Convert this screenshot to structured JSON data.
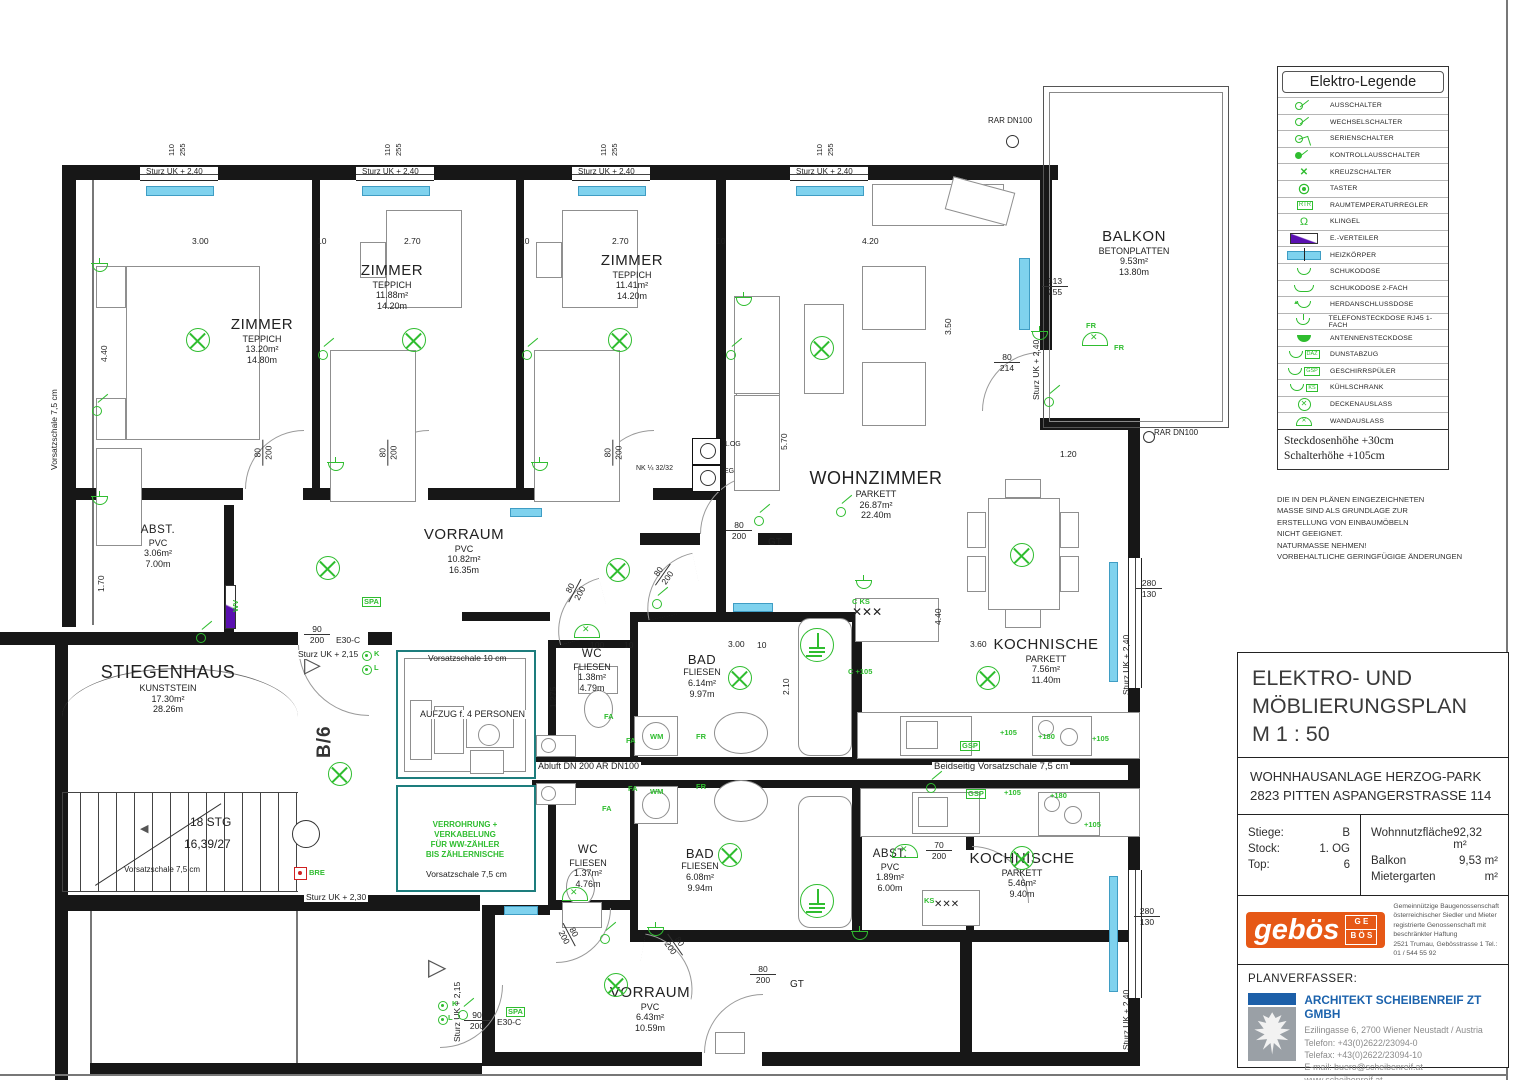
{
  "legend": {
    "title": "Elektro-Legende",
    "items": [
      {
        "icon": "ausschalter",
        "label": "AUSSCHALTER"
      },
      {
        "icon": "wechselschalter",
        "label": "WECHSELSCHALTER"
      },
      {
        "icon": "serienschalter",
        "label": "SERIENSCHALTER"
      },
      {
        "icon": "kontrollausschalter",
        "label": "KONTROLLAUSSCHALTER"
      },
      {
        "icon": "kreuzschalter",
        "label": "KREUZSCHALTER"
      },
      {
        "icon": "taster",
        "label": "TASTER"
      },
      {
        "icon": "rtr",
        "tag": "RTR",
        "label": "RAUMTEMPERATURREGLER"
      },
      {
        "icon": "klingel",
        "label": "KLINGEL"
      },
      {
        "icon": "everteiler",
        "label": "E.-VERTEILER"
      },
      {
        "icon": "heizkoerper",
        "label": "HEIZKÖRPER"
      },
      {
        "icon": "schuko",
        "label": "SCHUKODOSE"
      },
      {
        "icon": "schuko2",
        "label": "SCHUKODOSE 2-FACH"
      },
      {
        "icon": "herd",
        "label": "HERDANSCHLUSSDOSE"
      },
      {
        "icon": "telefon",
        "label": "TELEFONSTECKDOSE RJ45 1-FACH"
      },
      {
        "icon": "antenne",
        "label": "ANTENNENSTECKDOSE"
      },
      {
        "icon": "daz",
        "tag": "DAZ",
        "label": "DUNSTABZUG"
      },
      {
        "icon": "gsp",
        "tag": "GSP",
        "label": "GESCHIRRSPÜLER"
      },
      {
        "icon": "ks",
        "tag": "KS",
        "label": "KÜHLSCHRANK"
      },
      {
        "icon": "decke",
        "label": "DECKENAUSLASS"
      },
      {
        "icon": "wand",
        "label": "WANDAUSLASS"
      }
    ],
    "notes": [
      "Steckdosenhöhe  +30cm",
      "Schalterhöhe  +105cm"
    ],
    "disclaimer": [
      "DIE IN DEN PLÄNEN EINGEZEICHNETEN",
      "MASSE SIND ALS GRUNDLAGE ZUR",
      "ERSTELLUNG VON EINBAUMÖBELN",
      "NICHT GEEIGNET.",
      "NATURMASSE NEHMEN!",
      "VORBEHALTLICHE GERINGFÜGIGE ÄNDERUNGEN"
    ]
  },
  "title_block": {
    "title_lines": [
      "ELEKTRO- UND",
      "MÖBLIERUNGSPLAN",
      "M   1 : 50"
    ],
    "project_lines": [
      "WOHNHAUSANLAGE HERZOG-PARK",
      "2823 PITTEN ASPANGERSTRASSE 114"
    ],
    "info": {
      "stiege_label": "Stiege:",
      "stiege": "B",
      "stock_label": "Stock:",
      "stock": "1. OG",
      "top_label": "Top:",
      "top": "6",
      "wnf_label": "Wohnnutzfläche",
      "wnf": "92,32 m²",
      "balkon_label": "Balkon",
      "balkon": "9,53 m²",
      "garten_label": "Mietergarten",
      "garten": "m²"
    },
    "gebos": {
      "name": "gebös",
      "lines": [
        "Gemeinnützige Baugenossenschaft",
        "österreichischer Siedler und Mieter",
        "registrierte Genossenschaft mit beschränkter Haftung",
        "2521 Trumau, Gebösstrasse 1   Tel.: 01 / 544 55 92"
      ]
    },
    "planverfasser_label": "PLANVERFASSER:",
    "architect": {
      "name": "ARCHITEKT SCHEIBENREIF ZT GMBH",
      "address": "Ezilingasse 6, 2700 Wiener Neustadt / Austria",
      "phone": "Telefon: +43(0)2622/23094-0",
      "fax": "Telefax: +43(0)2622/23094-10",
      "email": "E-mail: buero@scheibenreif.at",
      "web": "www.scheibenreif.at"
    }
  },
  "rooms": {
    "zimmer1": {
      "name": "ZIMMER",
      "floor": "TEPPICH",
      "area": "13.20m²",
      "perimeter": "14.80m"
    },
    "zimmer2": {
      "name": "ZIMMER",
      "floor": "TEPPICH",
      "area": "11.88m²",
      "perimeter": "14.20m"
    },
    "zimmer3": {
      "name": "ZIMMER",
      "floor": "TEPPICH",
      "area": "11.41m²",
      "perimeter": "14.20m"
    },
    "wohnzimmer": {
      "name": "WOHNZIMMER",
      "floor": "PARKETT",
      "area": "26.87m²",
      "perimeter": "22.40m"
    },
    "balkon": {
      "name": "BALKON",
      "floor": "BETONPLATTEN",
      "area": "9.53m²",
      "perimeter": "13.80m"
    },
    "kochnische1": {
      "name": "KOCHNISCHE",
      "floor": "PARKETT",
      "area": "7.56m²",
      "perimeter": "11.40m"
    },
    "kochnische2": {
      "name": "KOCHNISCHE",
      "floor": "PARKETT",
      "area": "5.46m²",
      "perimeter": "9.40m"
    },
    "abst1": {
      "name": "ABST.",
      "floor": "PVC",
      "area": "3.06m²",
      "perimeter": "7.00m"
    },
    "abst2": {
      "name": "ABST.",
      "floor": "PVC",
      "area": "1.89m²",
      "perimeter": "6.00m"
    },
    "vorraum1": {
      "name": "VORRAUM",
      "floor": "PVC",
      "area": "10.82m²",
      "perimeter": "16.35m"
    },
    "vorraum2": {
      "name": "VORRAUM",
      "floor": "PVC",
      "area": "6.43m²",
      "perimeter": "10.59m"
    },
    "wc1": {
      "name": "WC",
      "floor": "FLIESEN",
      "area": "1.38m²",
      "perimeter": "4.79m"
    },
    "wc2": {
      "name": "WC",
      "floor": "FLIESEN",
      "area": "1.37m²",
      "perimeter": "4.76m"
    },
    "bad1": {
      "name": "BAD",
      "floor": "FLIESEN",
      "area": "6.14m²",
      "perimeter": "9.97m"
    },
    "bad2": {
      "name": "BAD",
      "floor": "FLIESEN",
      "area": "6.08m²",
      "perimeter": "9.94m"
    },
    "stiegenhaus": {
      "name": "STIEGENHAUS",
      "floor": "KUNSTSTEIN",
      "area": "17.30m²",
      "perimeter": "28.26m"
    }
  },
  "plan": {
    "b6": "B/6",
    "verrohrung": [
      "VERROHRUNG +",
      "VERKABELUNG",
      "FÜR WW-ZÄHLER",
      "BIS ZÄHLERNISCHE"
    ],
    "texts": [
      {
        "t": "Sturz UK + 2,40",
        "x": 146,
        "y": 168,
        "s": 8
      },
      {
        "t": "Sturz UK + 2,40",
        "x": 362,
        "y": 168,
        "s": 8
      },
      {
        "t": "Sturz UK + 2,40",
        "x": 578,
        "y": 168,
        "s": 8
      },
      {
        "t": "Sturz UK + 2,40",
        "x": 796,
        "y": 168,
        "s": 8
      },
      {
        "t": "3.00",
        "x": 192,
        "y": 237
      },
      {
        "t": "10",
        "x": 317,
        "y": 237
      },
      {
        "t": "2.70",
        "x": 404,
        "y": 237
      },
      {
        "t": "10",
        "x": 520,
        "y": 237
      },
      {
        "t": "2.70",
        "x": 612,
        "y": 237
      },
      {
        "t": "10",
        "x": 716,
        "y": 237
      },
      {
        "t": "4.20",
        "x": 862,
        "y": 237
      },
      {
        "t": "4.40",
        "x": 100,
        "y": 362,
        "r": -90
      },
      {
        "t": "1.70",
        "x": 97,
        "y": 592,
        "r": -90
      },
      {
        "t": "3.50",
        "x": 944,
        "y": 335,
        "r": -90
      },
      {
        "t": "5.70",
        "x": 780,
        "y": 450,
        "r": -90
      },
      {
        "t": "2.10",
        "x": 782,
        "y": 695,
        "r": -90
      },
      {
        "t": "4.40",
        "x": 934,
        "y": 625,
        "r": -90
      },
      {
        "t": "1.275",
        "x": 549,
        "y": 708,
        "r": -90
      },
      {
        "t": "1.20",
        "x": 1060,
        "y": 450
      },
      {
        "t": "3.60",
        "x": 970,
        "y": 640
      },
      {
        "t": "3.00",
        "x": 728,
        "y": 640
      },
      {
        "t": "100",
        "x": 590,
        "y": 641
      },
      {
        "t": "10",
        "x": 624,
        "y": 641
      },
      {
        "t": "10",
        "x": 757,
        "y": 641
      },
      {
        "t": "Sturz UK + 2,40",
        "x": 1032,
        "y": 400,
        "r": -90
      },
      {
        "t": "Sturz UK + 2,40",
        "x": 1122,
        "y": 695,
        "r": -90
      },
      {
        "t": "Sturz UK + 2,40",
        "x": 1122,
        "y": 1050,
        "r": -90
      },
      {
        "t": "Sturz UK + 2,15",
        "x": 296,
        "y": 650,
        "bg": 1
      },
      {
        "t": "Sturz UK + 2,15",
        "x": 453,
        "y": 1042,
        "r": -90
      },
      {
        "t": "Sturz UK + 2,30",
        "x": 304,
        "y": 893,
        "bg": 1
      },
      {
        "t": "Vorsatzschale 7,5 cm",
        "x": 50,
        "y": 470,
        "r": -90
      },
      {
        "t": "Vorsatzschale 7,5 cm",
        "x": 124,
        "y": 866,
        "s": 8
      },
      {
        "t": "Vorsatzschale 7,5 cm",
        "x": 426,
        "y": 870
      },
      {
        "t": "Vorsatzschale 10 cm",
        "x": 428,
        "y": 654
      },
      {
        "t": "Beidseitig Vorsatzschale 7,5 cm",
        "x": 932,
        "y": 762,
        "s": 9.5,
        "bg": 1
      },
      {
        "t": "Abluft DN 200   AR DN100",
        "x": 536,
        "y": 762,
        "s": 9,
        "bg": 1
      },
      {
        "t": "RAR DN100",
        "x": 988,
        "y": 117,
        "s": 8
      },
      {
        "t": "RAR DN100",
        "x": 1154,
        "y": 429,
        "s": 8
      },
      {
        "t": "E30-C",
        "x": 336,
        "y": 636
      },
      {
        "t": "E30-C",
        "x": 497,
        "y": 1018
      },
      {
        "t": "GT",
        "x": 768,
        "y": 538,
        "s": 10
      },
      {
        "t": "GT",
        "x": 790,
        "y": 980,
        "s": 10
      },
      {
        "t": "18 STG",
        "x": 190,
        "y": 816,
        "s": 12
      },
      {
        "t": "16,39/27",
        "x": 184,
        "y": 838,
        "s": 12
      },
      {
        "t": "AUFZUG f. 4 PERSONEN",
        "x": 418,
        "y": 710,
        "s": 9,
        "bg": 1
      },
      {
        "t": "NK ¼ 32/32",
        "x": 636,
        "y": 465,
        "s": 7
      },
      {
        "t": "1.OG",
        "x": 724,
        "y": 441,
        "s": 7
      },
      {
        "t": "EG",
        "x": 724,
        "y": 468,
        "s": 7
      },
      {
        "t": "110",
        "x": 168,
        "y": 156,
        "r": -90,
        "s": 7.5
      },
      {
        "t": "255",
        "x": 179,
        "y": 156,
        "r": -90,
        "s": 7.5
      },
      {
        "t": "110",
        "x": 384,
        "y": 156,
        "r": -90,
        "s": 7.5
      },
      {
        "t": "255",
        "x": 395,
        "y": 156,
        "r": -90,
        "s": 7.5
      },
      {
        "t": "110",
        "x": 600,
        "y": 156,
        "r": -90,
        "s": 7.5
      },
      {
        "t": "255",
        "x": 611,
        "y": 156,
        "r": -90,
        "s": 7.5
      },
      {
        "t": "110",
        "x": 816,
        "y": 156,
        "r": -90,
        "s": 7.5
      },
      {
        "t": "255",
        "x": 827,
        "y": 156,
        "r": -90,
        "s": 7.5
      },
      {
        "t": "✕✕✕",
        "x": 852,
        "y": 606,
        "s": 12
      },
      {
        "t": "✕✕✕",
        "x": 934,
        "y": 900,
        "s": 10
      }
    ],
    "fracs": [
      {
        "a": "80",
        "b": "200",
        "x": 250,
        "y": 442,
        "r": -90
      },
      {
        "a": "80",
        "b": "200",
        "x": 375,
        "y": 442,
        "r": -90
      },
      {
        "a": "80",
        "b": "200",
        "x": 600,
        "y": 442,
        "r": -90
      },
      {
        "a": "80",
        "b": "200",
        "x": 726,
        "y": 520
      },
      {
        "a": "80",
        "b": "214",
        "x": 994,
        "y": 352
      },
      {
        "a": "80",
        "b": "200",
        "x": 562,
        "y": 580,
        "r": -62
      },
      {
        "a": "80",
        "b": "200",
        "x": 650,
        "y": 564,
        "r": -55
      },
      {
        "a": "80",
        "b": "200",
        "x": 556,
        "y": 924,
        "r": 62
      },
      {
        "a": "80",
        "b": "200",
        "x": 662,
        "y": 934,
        "r": 55
      },
      {
        "a": "80",
        "b": "200",
        "x": 750,
        "y": 964
      },
      {
        "a": "70",
        "b": "200",
        "x": 926,
        "y": 840
      },
      {
        "a": "90",
        "b": "200",
        "x": 304,
        "y": 624
      },
      {
        "a": "90",
        "b": "200",
        "x": 464,
        "y": 1010
      },
      {
        "a": "313",
        "b": "255",
        "x": 1042,
        "y": 276
      },
      {
        "a": "280",
        "b": "130",
        "x": 1136,
        "y": 578
      },
      {
        "a": "280",
        "b": "130",
        "x": 1134,
        "y": 906
      }
    ],
    "green": [
      {
        "t": "SPA",
        "x": 362,
        "y": 597,
        "box": 1
      },
      {
        "t": "SPA",
        "x": 506,
        "y": 1007,
        "box": 1
      },
      {
        "t": "BRE",
        "x": 309,
        "y": 869
      },
      {
        "t": "C KS",
        "x": 852,
        "y": 598
      },
      {
        "t": "C +105",
        "x": 848,
        "y": 668
      },
      {
        "t": "GSP",
        "x": 960,
        "y": 741,
        "box": 1
      },
      {
        "t": "+105",
        "x": 1000,
        "y": 729
      },
      {
        "t": "+180",
        "x": 1038,
        "y": 733
      },
      {
        "t": "+105",
        "x": 1092,
        "y": 735
      },
      {
        "t": "GSP",
        "x": 966,
        "y": 789,
        "box": 1
      },
      {
        "t": "+105",
        "x": 1004,
        "y": 789
      },
      {
        "t": "+180",
        "x": 1050,
        "y": 792
      },
      {
        "t": "+105",
        "x": 1084,
        "y": 821
      },
      {
        "t": "KS",
        "x": 924,
        "y": 897
      },
      {
        "t": "K",
        "x": 374,
        "y": 650
      },
      {
        "t": "L",
        "x": 374,
        "y": 664
      },
      {
        "t": "K",
        "x": 452,
        "y": 1000
      },
      {
        "t": "L",
        "x": 448,
        "y": 1014
      },
      {
        "t": "FR",
        "x": 1086,
        "y": 322
      },
      {
        "t": "FR",
        "x": 1114,
        "y": 344
      },
      {
        "t": "FA",
        "x": 626,
        "y": 737
      },
      {
        "t": "WM",
        "x": 650,
        "y": 733
      },
      {
        "t": "FR",
        "x": 696,
        "y": 733
      },
      {
        "t": "FA",
        "x": 628,
        "y": 785
      },
      {
        "t": "WM",
        "x": 650,
        "y": 788
      },
      {
        "t": "FR",
        "x": 696,
        "y": 783
      },
      {
        "t": "FA",
        "x": 604,
        "y": 713
      },
      {
        "t": "FA",
        "x": 602,
        "y": 805
      },
      {
        "t": "WV",
        "x": 232,
        "y": 612,
        "r": -90
      }
    ],
    "symbols": {
      "ceil": [
        [
          186,
          328
        ],
        [
          402,
          328
        ],
        [
          608,
          328
        ],
        [
          810,
          336
        ],
        [
          316,
          556
        ],
        [
          606,
          558
        ],
        [
          328,
          762
        ],
        [
          728,
          666
        ],
        [
          718,
          843
        ],
        [
          976,
          666
        ],
        [
          1010,
          543
        ],
        [
          1010,
          846
        ],
        [
          604,
          973
        ]
      ],
      "wand": [
        [
          574,
          624
        ],
        [
          562,
          887
        ],
        [
          892,
          844
        ]
      ],
      "fan": [
        [
          1082,
          332
        ]
      ],
      "earth": [
        [
          800,
          628
        ],
        [
          800,
          884
        ]
      ],
      "dot": [
        [
          362,
          651
        ],
        [
          362,
          665
        ],
        [
          438,
          1001
        ],
        [
          438,
          1015
        ]
      ],
      "sw": [
        [
          92,
          406
        ],
        [
          318,
          350
        ],
        [
          522,
          350
        ],
        [
          726,
          350
        ],
        [
          754,
          516
        ],
        [
          600,
          934
        ],
        [
          458,
          1010
        ],
        [
          926,
          783
        ],
        [
          1044,
          397
        ],
        [
          836,
          507
        ],
        [
          196,
          633
        ],
        [
          652,
          599
        ]
      ],
      "sock": [
        [
          92,
          264
        ],
        [
          92,
          497
        ],
        [
          328,
          463
        ],
        [
          532,
          463
        ],
        [
          736,
          298
        ],
        [
          1032,
          332
        ],
        [
          856,
          581
        ],
        [
          648,
          928
        ],
        [
          852,
          932
        ]
      ]
    }
  }
}
